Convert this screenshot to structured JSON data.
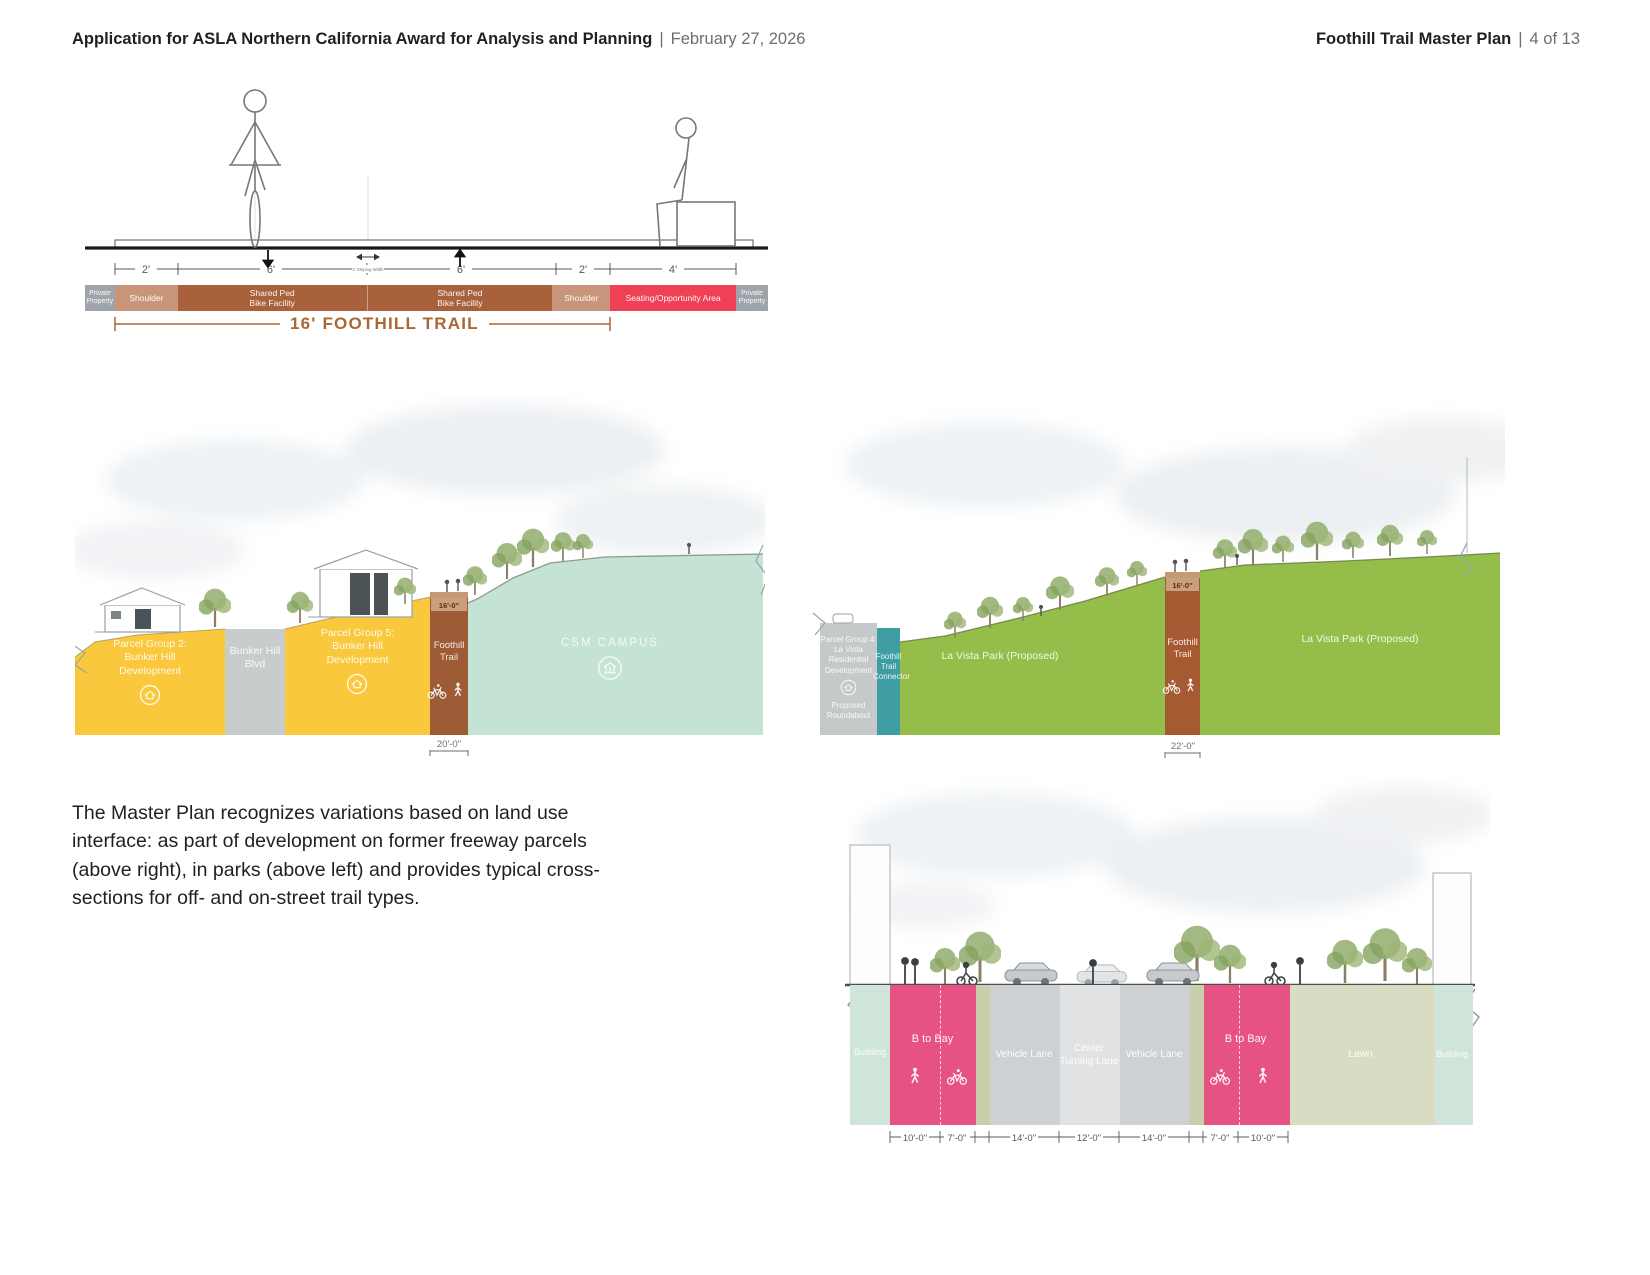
{
  "header": {
    "left_bold": "Application for ASLA Northern California Award for Analysis and Planning",
    "divider": "|",
    "left_regular": "February 27, 2026",
    "right_bold": "Foothill Trail Master Plan",
    "right_regular": "4 of 13"
  },
  "typical_section": {
    "dims": {
      "d1": "2'",
      "d2": "6'",
      "d3": "6'",
      "d4": "2'",
      "d5": "4'"
    },
    "center_note": "2' Striping Width",
    "bands": {
      "pp_left": "Private\nProperty",
      "shoulder_left": "Shoulder",
      "shared_left": "Shared Ped\nBike Facility",
      "shared_right": "Shared Ped\nBike Facility",
      "shoulder_right": "Shoulder",
      "seating": "Seating/Opportunity Area",
      "pp_right": "Private\nProperty"
    },
    "total": "16' FOOTHILL TRAIL"
  },
  "bunker_section": {
    "parcel2": "Parcel Group 2:\nBunker Hill\nDevelopment",
    "blvd": "Bunker Hill\nBlvd",
    "parcel5": "Parcel Group 5:\nBunker Hill\nDevelopment",
    "trail": "Foothill\nTrail",
    "trail_width": "16'-0\"",
    "campus": "CSM CAMPUS",
    "bottom_dim": "20'-0\""
  },
  "lavista_section": {
    "parcel4": "Parcel Group 4:\nLa Vista\nResidential\nDevelopment",
    "roundabout": "Proposed\nRoundabout",
    "connector": "Foothill\nTrail\nConnector",
    "park_left": "La Vista Park (Proposed)",
    "park_right": "La Vista Park (Proposed)",
    "trail": "Foothill\nTrail",
    "trail_width": "16'-0\"",
    "bottom_dim": "22'-0\""
  },
  "body_text": "The Master Plan recognizes variations based on land use\ninterface: as part of development on former freeway parcels\n(above right), in parks (above left) and provides typical cross-\nsections for off- and on-street trail types.",
  "street_section": {
    "building_left": "Building",
    "btobay_left": "B to Bay",
    "vehicle_left": "Vehicle Lane",
    "center_lane": "Center\nTurning Lane",
    "vehicle_right": "Vehicle Lane",
    "btobay_right": "B to Bay",
    "lawn": "Lawn",
    "building_right": "Building",
    "dims": {
      "d1": "10'-0\"",
      "d2": "7'-0\"",
      "d3": "14'-0\"",
      "d4": "12'-0\"",
      "d5": "14'-0\"",
      "d6": "7'-0\"",
      "d7": "10'-0\""
    }
  },
  "colors": {
    "trail_brown": "#a8613b",
    "seating_red": "#ee4156",
    "parcel_yellow": "#fac83c",
    "campus_teal": "#c5e3d4",
    "park_green": "#94bd4a",
    "connector_teal": "#3f9ea3",
    "btobay_pink": "#e65284",
    "lawn_olive": "#d8dcc2",
    "heading_brown": "#ab6633"
  }
}
